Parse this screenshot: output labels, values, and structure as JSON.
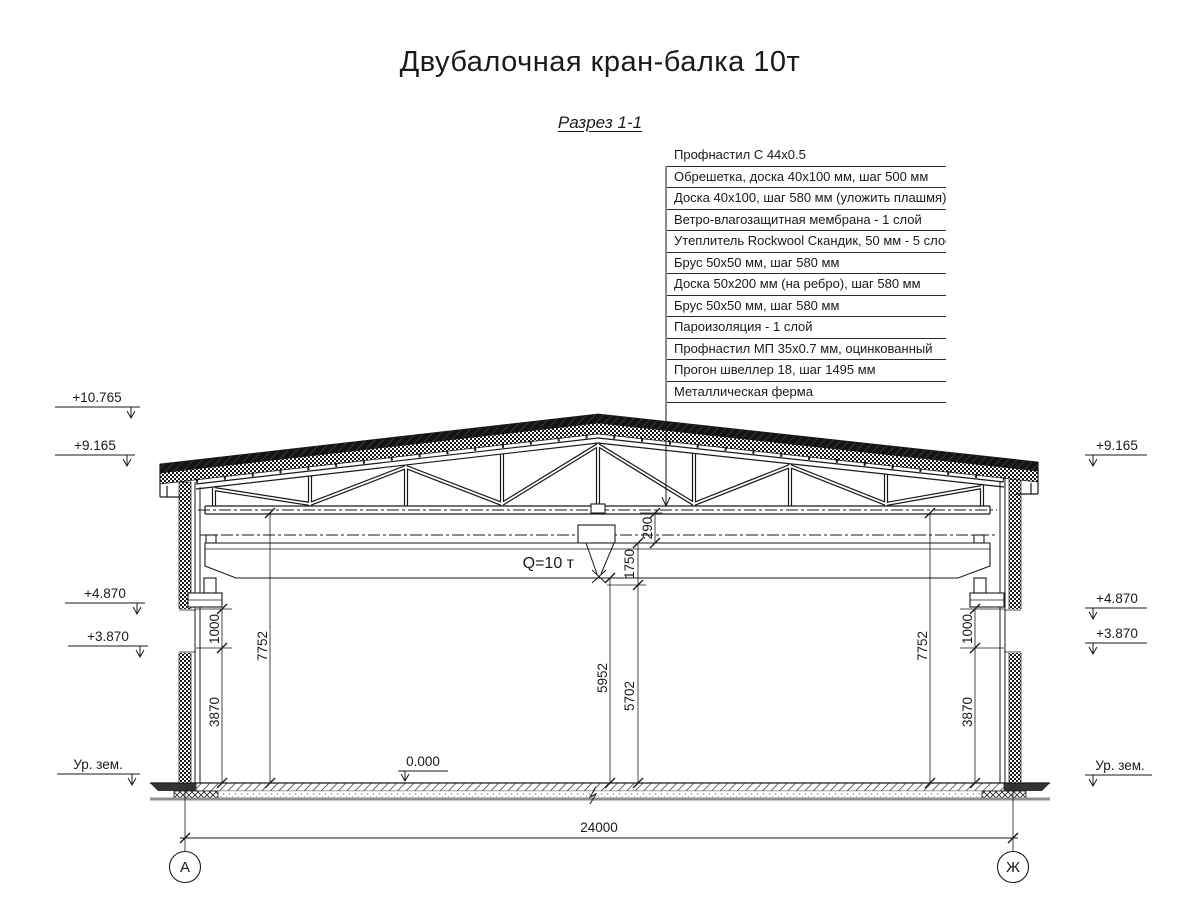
{
  "title": "Двубалочная кран-балка 10т",
  "section_label": "Разрез 1-1",
  "crane_label": "Q=10 т",
  "roof_layers": [
    "Профнастил С 44х0.5",
    "Обрешетка, доска 40х100 мм, шаг 500 мм",
    "Доска 40х100, шаг 580 мм (уложить плашмя)",
    "Ветро-влагозащитная мембрана - 1 слой",
    "Утеплитель Rockwool Скандик, 50 мм - 5 слоев",
    "Брус 50х50 мм, шаг 580 мм",
    "Доска 50х200 мм (на ребро), шаг 580 мм",
    "Брус 50х50 мм, шаг 580 мм",
    "Пароизоляция - 1 слой",
    "Профнастил МП 35х0.7 мм, оцинкованный",
    "Прогон швеллер 18, шаг 1495 мм",
    "Металлическая ферма"
  ],
  "elevations": {
    "left": {
      "ridge": "+10.765",
      "eave": "+9.165",
      "rail_top": "+4.870",
      "bracket": "+3.870",
      "ground": "Ур. зем."
    },
    "right": {
      "eave": "+9.165",
      "rail_top": "+4.870",
      "bracket": "+3.870",
      "ground": "Ур. зем."
    },
    "floor": "0.000"
  },
  "dimensions": {
    "span": "24000",
    "left_wall": {
      "clear_height": "7752",
      "rail_zone": "1000",
      "lower_wall": "3870"
    },
    "right_wall": {
      "clear_height": "7752",
      "rail_zone": "1000",
      "lower_wall": "3870"
    },
    "center": {
      "under_girder": "5952",
      "hook_lift": "5702",
      "girder_zone": "1750",
      "truss_clearance": "290"
    }
  },
  "axes": {
    "left": "А",
    "right": "Ж"
  },
  "colors": {
    "line": "#1a1a1a",
    "ground_line": "#8f8f8f"
  }
}
